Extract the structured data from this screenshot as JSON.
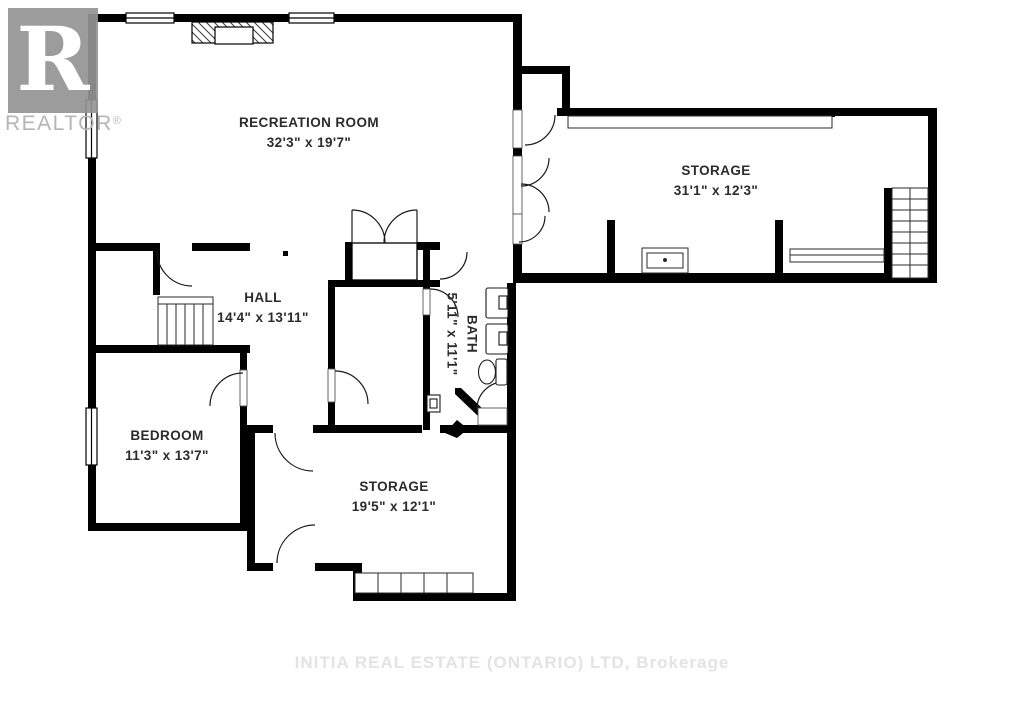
{
  "watermarks": {
    "logo_letter": "R",
    "logo_text": "REALTOR",
    "registered": "®",
    "brokerage": "INITIA REAL ESTATE (ONTARIO) LTD, Brokerage"
  },
  "rooms": [
    {
      "id": "recreation-room",
      "name": "RECREATION ROOM",
      "dims": "32'3\" x 19'7\""
    },
    {
      "id": "storage-upper",
      "name": "STORAGE",
      "dims": "31'1\" x 12'3\""
    },
    {
      "id": "hall",
      "name": "HALL",
      "dims": "14'4\" x 13'11\""
    },
    {
      "id": "bath",
      "name": "BATH",
      "dims": "5'11\" x 11'1\""
    },
    {
      "id": "bedroom",
      "name": "BEDROOM",
      "dims": "11'3\" x 13'7\""
    },
    {
      "id": "storage-lower",
      "name": "STORAGE",
      "dims": "19'5\" x 12'1\""
    }
  ],
  "colors": {
    "walls": "#000000",
    "labels": "#2b2b2b",
    "logo_gray": "#949494",
    "watermark_gray": "#e3e3e3"
  }
}
